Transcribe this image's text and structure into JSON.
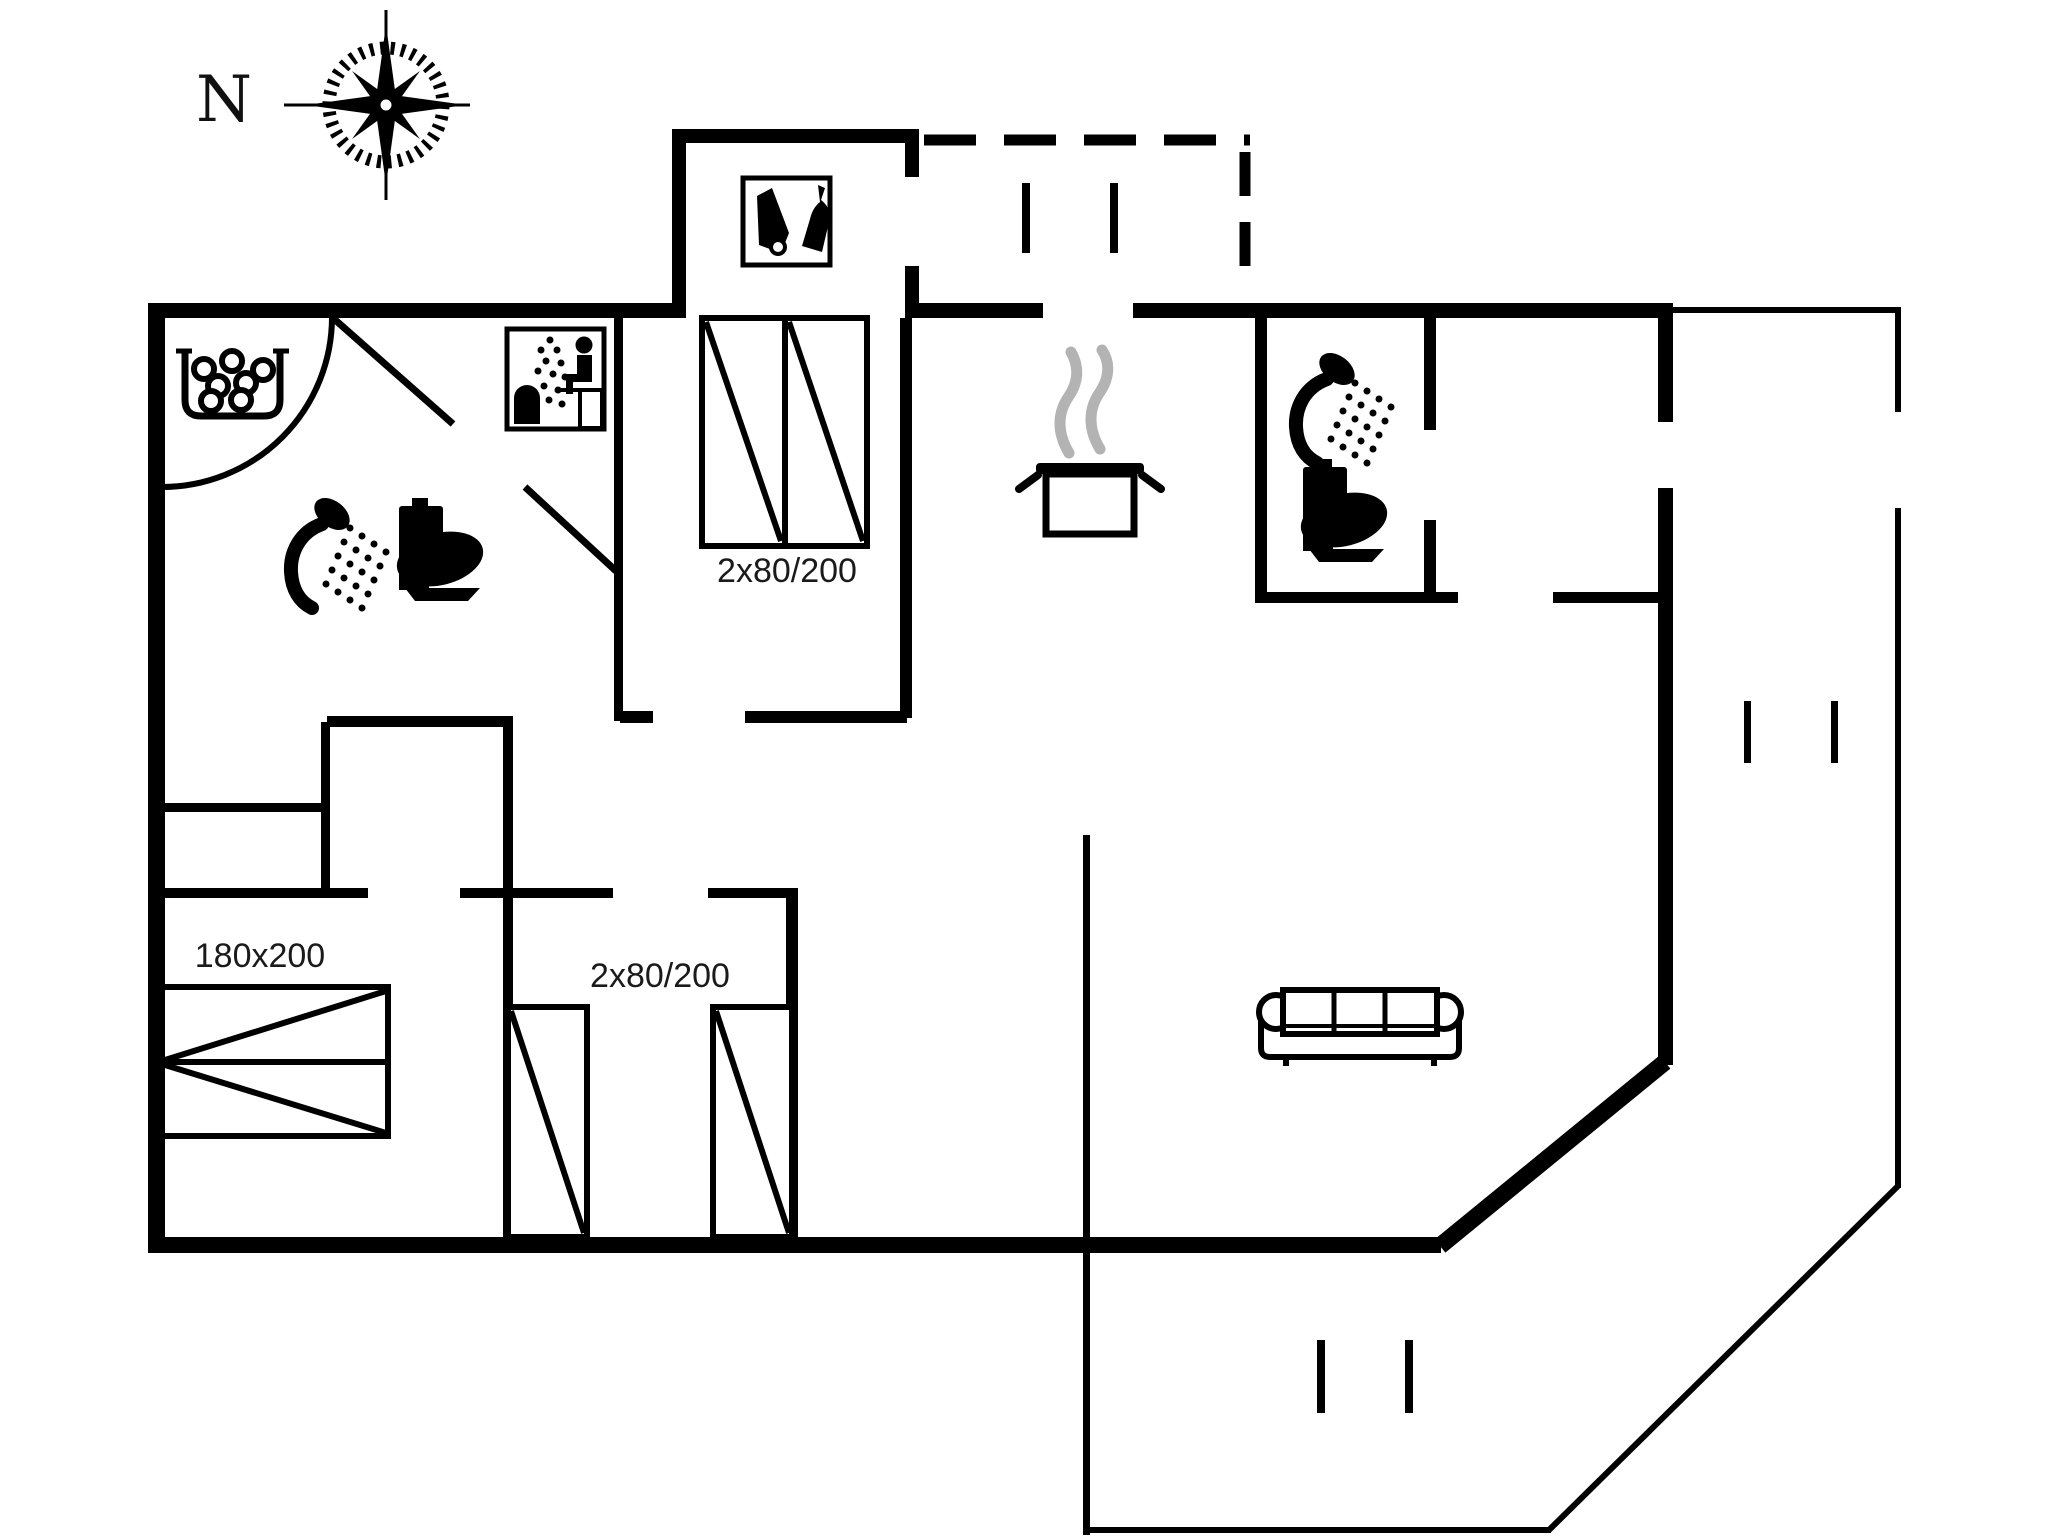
{
  "canvas": {
    "background": "#ffffff",
    "ink": "#000000",
    "steam_color": "#b3b3b3"
  },
  "compass": {
    "label": "N"
  },
  "bed_labels": {
    "north_bedroom": "2x80/200",
    "southwest_bedroom": "180x200",
    "south_bedroom": "2x80/200"
  },
  "icons": {
    "compass_rose": "compass-rose-icon",
    "whirlpool": "whirlpool-bath-icon",
    "sauna": "sauna-icon",
    "utility": "cleaning-equipment-icon",
    "shower_west": "shower-icon",
    "toilet_west": "toilet-icon",
    "cooking_pot": "cooking-pot-icon",
    "shower_east": "shower-icon",
    "toilet_east": "toilet-icon",
    "sofa": "sofa-icon",
    "double_bed_north": "double-bed-icon",
    "double_bed_southwest": "double-bed-icon",
    "single_beds_south": "single-bed-icon"
  }
}
